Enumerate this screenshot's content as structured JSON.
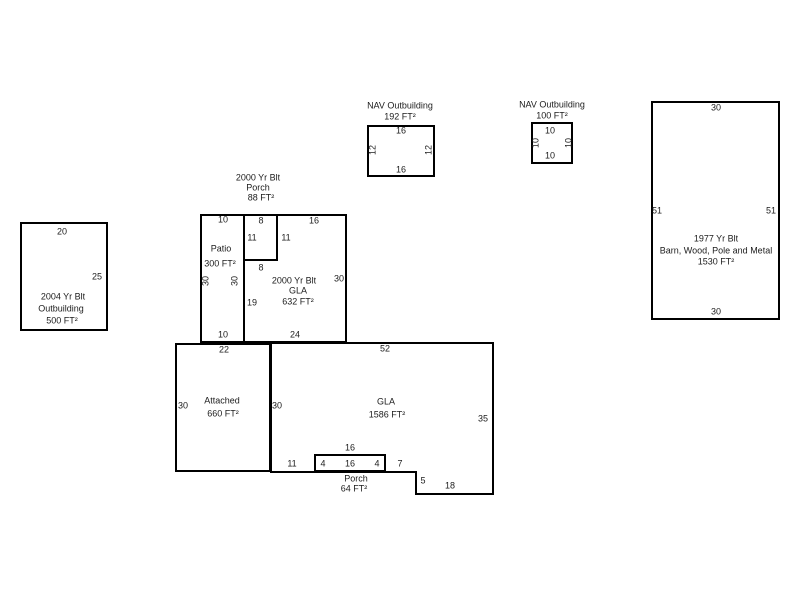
{
  "sketch": {
    "nav_outbuilding_192": {
      "title": "NAV Outbuilding",
      "area": "192 FT²",
      "dim_top": "16",
      "dim_left": "12",
      "dim_right": "12",
      "dim_bottom": "16"
    },
    "nav_outbuilding_100": {
      "title": "NAV Outbuilding",
      "area": "100 FT²",
      "dim_top": "10",
      "dim_left": "10",
      "dim_right": "10",
      "dim_bottom": "10"
    },
    "barn_1977": {
      "line1": "1977 Yr Blt",
      "line2": "Barn, Wood, Pole and Metal",
      "line3": "1530 FT²",
      "dim_top": "30",
      "dim_left": "51",
      "dim_right": "51",
      "dim_bottom": "30"
    },
    "outbuilding_2004": {
      "line1": "2004 Yr Blt",
      "line2": "Outbuilding",
      "line3": "500 FT²",
      "dim_top": "20",
      "dim_right": "25"
    },
    "house_2000": {
      "header_line1": "2000 Yr Blt",
      "header_line2": "Porch",
      "header_line3": "88 FT²",
      "patio": {
        "name": "Patio",
        "area": "300 FT²",
        "dim_top": "10",
        "dim_left": "30",
        "dim_right": "30",
        "dim_bottom": "10"
      },
      "porch": {
        "dim_top": "8",
        "dim_left": "11",
        "dim_right": "11",
        "dim_bottom": "8"
      },
      "gla": {
        "line1": "2000 Yr Blt",
        "line2": "GLA",
        "line3": "632 FT²",
        "dim_top": "16",
        "dim_left": "19",
        "dim_right": "30",
        "dim_bottom": "24"
      }
    },
    "main_floor": {
      "attached": {
        "name": "Attached",
        "area": "660 FT²",
        "dim_top": "22",
        "dim_left": "30"
      },
      "gla": {
        "name": "GLA",
        "area": "1586 FT²",
        "dim_top": "52",
        "dim_left": "30",
        "dim_right": "35",
        "dim_above_porch": "16",
        "dim_left_of_porch": "11",
        "dim_right_of_porch": "7",
        "dim_step": "5",
        "dim_bottom_right": "18"
      },
      "porch": {
        "name": "Porch",
        "area": "64 FT²",
        "dim_in_left": "4",
        "dim_in_mid": "16",
        "dim_in_right": "4"
      }
    }
  }
}
